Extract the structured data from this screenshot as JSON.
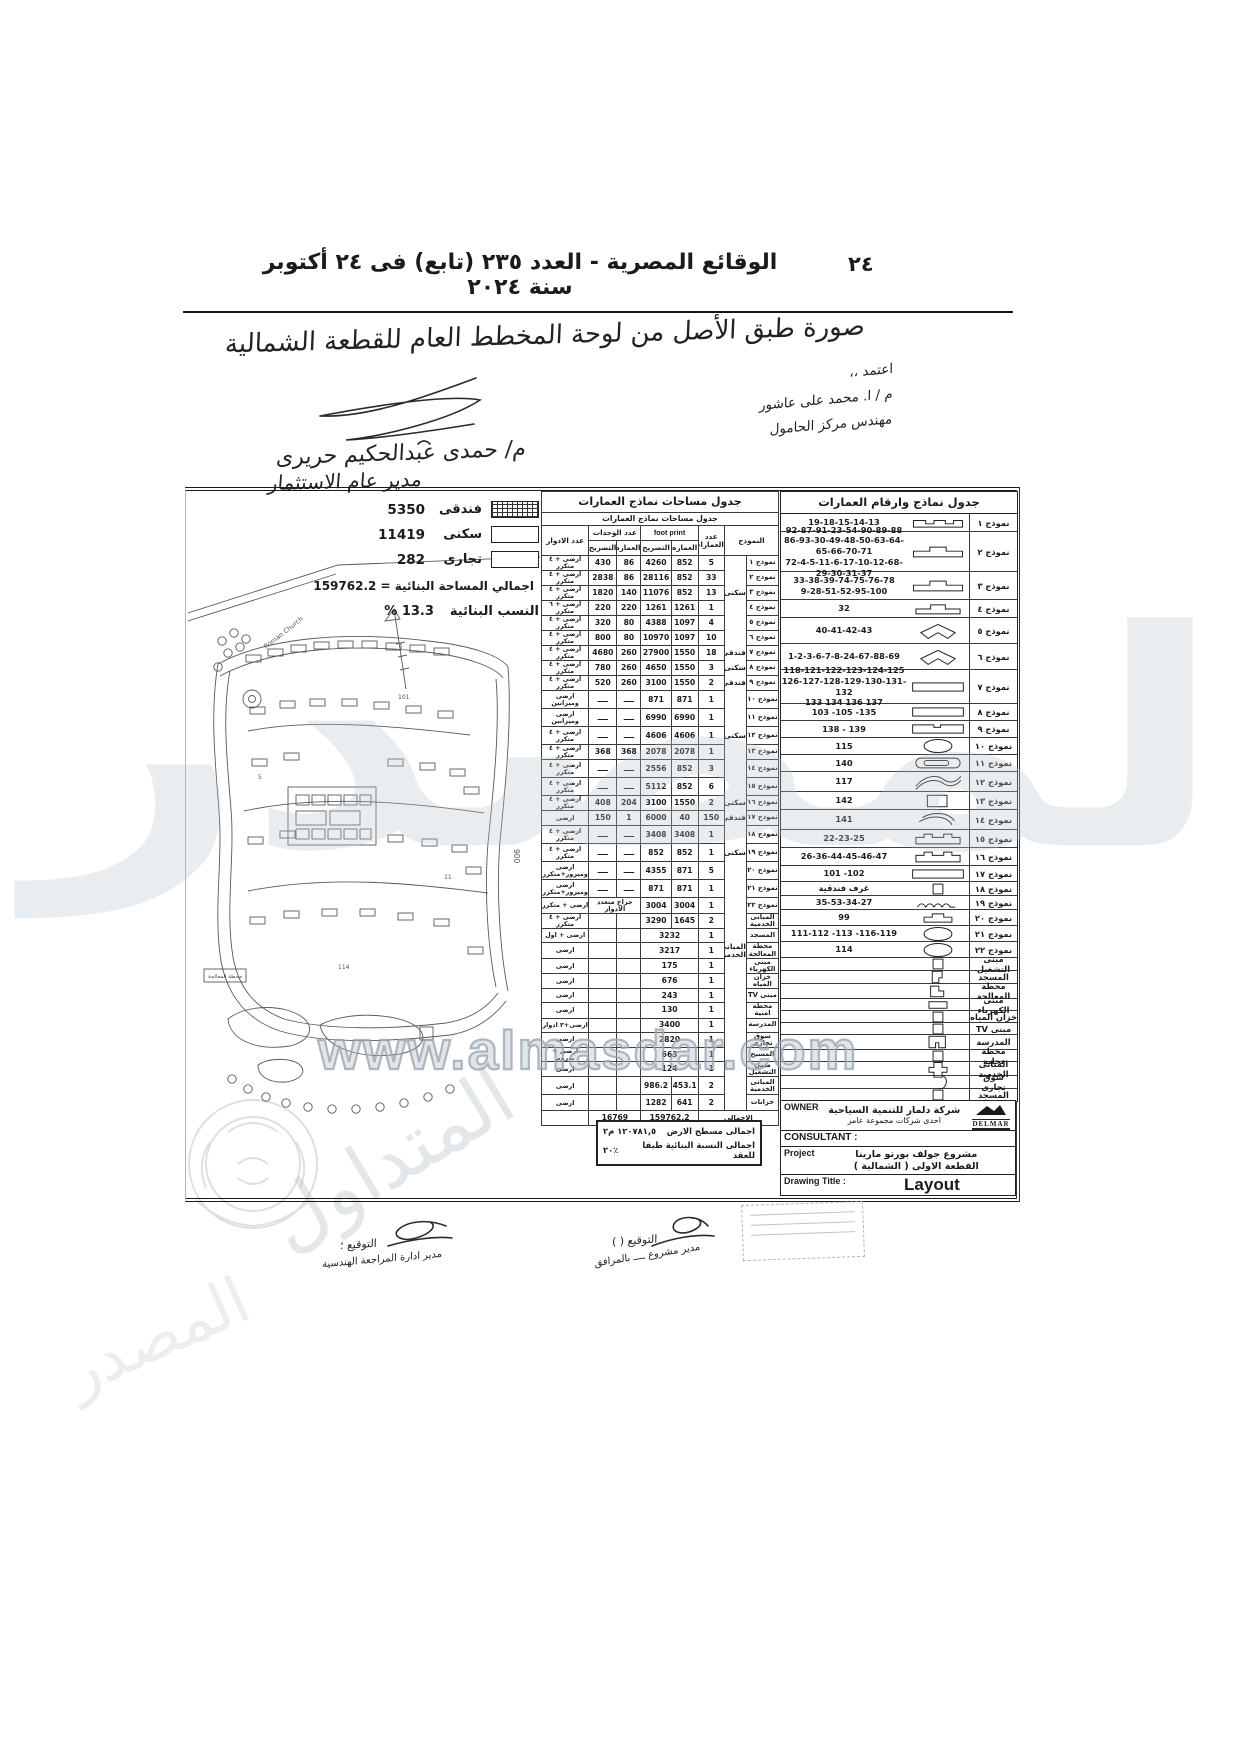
{
  "header": {
    "page_number": "٢٤",
    "gazette_title": "الوقائع المصرية - العدد ٢٣٥ (تابع) فى ٢٤ أكتوبر سنة ٢٠٢٤"
  },
  "handwritten": {
    "copy_note": "صورة طبق الأصل من لوحة المخطط العام للقطعة الشمالية",
    "approved_1": "اعتمد ،،",
    "approved_2": "م / ا. محمد على عاشور",
    "approved_3": "مهندس مركز الحامول",
    "name": "م/ حمدى عبدالحكيم حريرى",
    "job": "مدير عام الاستثمار",
    "sig_left_label": "التوقيع ؛",
    "sig_left_sub": "مدير ادارة المراجعة الهندسية",
    "sig_right_label": "التوقيع (      )",
    "sig_right_sub": "مدير مشروع ــــ بالمرافق"
  },
  "legend": {
    "items": [
      {
        "label": "فندقى",
        "value": "5350",
        "swatch": "hatched"
      },
      {
        "label": "سكنى",
        "value": "11419",
        "swatch": "plain"
      },
      {
        "label": "تجارى",
        "value": "282",
        "swatch": "plain"
      }
    ],
    "total_line": "اجمالي المساحة البنائية = 159762.2",
    "ratio_label": "النسب البنائية",
    "ratio_value": "% 13.3"
  },
  "map": {
    "church": "Roman Church",
    "road": "900",
    "station": "محطة المعالجة",
    "num1": "101",
    "num2": "5",
    "num3": "11",
    "num4": "114"
  },
  "area_table": {
    "title": "جدول مساحات نماذج العمارات",
    "subtitle": "جدول مساحات نماذج العمارات",
    "headers": {
      "model": "النموذج",
      "count": "عدد العمارات",
      "footprint": "foot print",
      "units": "عدد الوحدات",
      "floors": "عدد الادوار",
      "bldg": "العماره",
      "permit": "التصريح"
    },
    "rows": [
      {
        "m": "نموذج ١",
        "cat": "",
        "n": "5",
        "fb": "852",
        "ft": "4260",
        "ub": "86",
        "ut": "430",
        "fl": "ارضى + ٤ متكرر"
      },
      {
        "m": "نموذج ٢",
        "cat": "",
        "n": "33",
        "fb": "852",
        "ft": "28116",
        "ub": "86",
        "ut": "2838",
        "fl": "ارضى + ٤ متكرر"
      },
      {
        "m": "نموذج ٣",
        "cat": "سكنى",
        "n": "13",
        "fb": "852",
        "ft": "11076",
        "ub": "140",
        "ut": "1820",
        "fl": "ارضى + ٤ متكرر"
      },
      {
        "m": "نموذج ٤",
        "cat": "",
        "n": "1",
        "fb": "1261",
        "ft": "1261",
        "ub": "220",
        "ut": "220",
        "fl": "ارضى + ٦ متكرر"
      },
      {
        "m": "نموذج ٥",
        "cat": "",
        "n": "4",
        "fb": "1097",
        "ft": "4388",
        "ub": "80",
        "ut": "320",
        "fl": "ارضى + ٤ متكرر"
      },
      {
        "m": "نموذج ٦",
        "cat": "",
        "n": "10",
        "fb": "1097",
        "ft": "10970",
        "ub": "80",
        "ut": "800",
        "fl": "ارضى + ٤ متكرر"
      },
      {
        "m": "نموذج ٧",
        "cat": "فندقى",
        "n": "18",
        "fb": "1550",
        "ft": "27900",
        "ub": "260",
        "ut": "4680",
        "fl": "ارضى + ٤ متكرر"
      },
      {
        "m": "نموذج ٨",
        "cat": "سكنى",
        "n": "3",
        "fb": "1550",
        "ft": "4650",
        "ub": "260",
        "ut": "780",
        "fl": "ارضى + ٤ متكرر"
      },
      {
        "m": "نموذج ٩",
        "cat": "فندقى",
        "n": "2",
        "fb": "1550",
        "ft": "3100",
        "ub": "260",
        "ut": "520",
        "fl": "ارضى + ٤ متكرر"
      },
      {
        "m": "نموذج ١٠",
        "cat": "",
        "n": "1",
        "fb": "871",
        "ft": "871",
        "ub": "ــــ",
        "ut": "ــــ",
        "fl": "ارضى وميزانين",
        "big": true
      },
      {
        "m": "نموذج ١١",
        "cat": "",
        "n": "1",
        "fb": "6990",
        "ft": "6990",
        "ub": "ــــ",
        "ut": "ــــ",
        "fl": "ارضى وميزانين",
        "big": true
      },
      {
        "m": "نموذج ١٢",
        "cat": "سكنى",
        "n": "1",
        "fb": "4606",
        "ft": "4606",
        "ub": "ــــ",
        "ut": "ــــ",
        "fl": "ارضى + ٤ متكرر",
        "big": true
      },
      {
        "m": "نموذج ١٣",
        "cat": "",
        "n": "1",
        "fb": "2078",
        "ft": "2078",
        "ub": "368",
        "ut": "368",
        "fl": "ارضى + ٤ متكرر"
      },
      {
        "m": "نموذج ١٤",
        "cat": "",
        "n": "3",
        "fb": "852",
        "ft": "2556",
        "ub": "ــــ",
        "ut": "ــــ",
        "fl": "ارضى + ٤ متكرر",
        "big": true
      },
      {
        "m": "نموذج ١٥",
        "cat": "",
        "n": "6",
        "fb": "852",
        "ft": "5112",
        "ub": "ــــ",
        "ut": "ــــ",
        "fl": "ارضى + ٤ متكرر",
        "big": true
      },
      {
        "m": "نموذج ١٦",
        "cat": "سكنى",
        "n": "2",
        "fb": "1550",
        "ft": "3100",
        "ub": "204",
        "ut": "408",
        "fl": "ارضى + ٤ متكرر"
      },
      {
        "m": "نموذج ١٧",
        "cat": "فندقى",
        "n": "150",
        "fb": "40",
        "ft": "6000",
        "ub": "1",
        "ut": "150",
        "fl": "ارضى"
      },
      {
        "m": "نموذج ١٨",
        "cat": "",
        "n": "1",
        "fb": "3408",
        "ft": "3408",
        "ub": "ــــ",
        "ut": "ــــ",
        "fl": "ارضى + ٤ متكرر",
        "big": true
      },
      {
        "m": "نموذج ١٩",
        "cat": "سكنى",
        "n": "1",
        "fb": "852",
        "ft": "852",
        "ub": "ــــ",
        "ut": "ــــ",
        "fl": "ارضى + ٤ متكرر",
        "big": true
      },
      {
        "m": "نموذج ٢٠",
        "cat": "",
        "n": "5",
        "fb": "871",
        "ft": "4355",
        "ub": "ــــ",
        "ut": "ــــ",
        "fl": "ارضى وميزور+متكرر",
        "big": true
      },
      {
        "m": "نموذج ٢١",
        "cat": "",
        "n": "1",
        "fb": "871",
        "ft": "871",
        "ub": "ــــ",
        "ut": "ــــ",
        "fl": "ارضى وميزور+متكرر",
        "big": true
      },
      {
        "m": "نموذج ٢٢",
        "cat": "",
        "n": "1",
        "fb": "3004",
        "ft": "3004",
        "note": "جراج متعدد الادوار",
        "fl": "ارضى + متكرر",
        "mid": true
      },
      {
        "m": "المبانى الخدمية",
        "cat": "",
        "n": "2",
        "fb": "1645",
        "ft": "3290",
        "ub": "",
        "ut": "",
        "fl": "ارضى + ٤ متكرر"
      },
      {
        "m": "المسجد",
        "cat": "",
        "n": "1",
        "ft": "3232",
        "fspan": true,
        "fl": "ارضى + اول",
        "sm": true
      },
      {
        "m": "محطة المعالجة",
        "cat": "المبانى الخدمية",
        "n": "1",
        "ft": "3217",
        "fspan": true,
        "fl": "ارضى",
        "sm": true
      },
      {
        "m": "مبنى الكهرباء",
        "cat": "",
        "n": "1",
        "ft": "175",
        "fspan": true,
        "fl": "ارضى",
        "sm": true
      },
      {
        "m": "خزان المياه",
        "cat": "",
        "n": "1",
        "ft": "676",
        "fspan": true,
        "fl": "ارضى",
        "sm": true
      },
      {
        "m": "مبنى TV",
        "cat": "",
        "n": "1",
        "ft": "243",
        "fspan": true,
        "fl": "ارضى",
        "sm": true
      },
      {
        "m": "محطة امنية",
        "cat": "",
        "n": "1",
        "ft": "130",
        "fspan": true,
        "fl": "ارضى",
        "sm": true
      },
      {
        "m": "المدرسة",
        "cat": "",
        "n": "1",
        "ft": "3400",
        "fspan": true,
        "fl": "ارضى+٣ ادوار",
        "sm": true
      },
      {
        "m": "سوق تجارى",
        "cat": "",
        "n": "1",
        "ft": "2820",
        "fspan": true,
        "fl": "ارضى",
        "sm": true
      },
      {
        "m": "المسبح",
        "cat": "",
        "n": "1",
        "ft": "663",
        "fspan": true,
        "fl": "ارضى + بدروم",
        "sm": true
      },
      {
        "m": "مبنى التشغيل",
        "cat": "",
        "n": "1",
        "ft": "124",
        "fspan": true,
        "fl": "ارضى",
        "sm": true
      },
      {
        "m": "المبانى الخدمية",
        "cat": "",
        "n": "2",
        "fb": "453.1",
        "ft": "986.2",
        "ub": "",
        "ut": "",
        "fl": "ارضى",
        "big": true
      },
      {
        "m": "خزانات",
        "cat": "",
        "n": "2",
        "fb": "641",
        "ft": "1282",
        "ub": "",
        "ut": "",
        "fl": "ارضى",
        "mid": true
      }
    ],
    "totals": {
      "label": "الاجمالى",
      "units": "16769",
      "footprint": "159762.2"
    }
  },
  "model_table": {
    "title": "جدول نماذج وارقام العمارات",
    "rows": [
      {
        "m": "نموذج ١",
        "icon": "cren-a",
        "nums": [
          "19-18-15-14-13"
        ],
        "h": 18
      },
      {
        "m": "نموذج ٢",
        "icon": "cren-b",
        "nums": [
          "92-87-91-23-54-90-89-88",
          "86-93-30-49-48-50-63-64-65-66-70-71",
          "72-4-5-11-6-17-10-12-68-29-30-31-37"
        ],
        "h": 40
      },
      {
        "m": "نموذج ٣",
        "icon": "cren-b",
        "nums": [
          "33-38-39-74-75-76-78",
          "9-28-51-52-95-100"
        ],
        "h": 28
      },
      {
        "m": "نموذج ٤",
        "icon": "cren-c",
        "nums": [
          "32"
        ],
        "h": 18
      },
      {
        "m": "نموذج ٥",
        "icon": "wing",
        "nums": [
          "40-41-42-43"
        ],
        "h": 26
      },
      {
        "m": "نموذج ٦",
        "icon": "wing",
        "nums": [
          "1-2-3-6-7-8-24-67-88-69"
        ],
        "h": 26
      },
      {
        "m": "نموذج ٧",
        "icon": "longbar",
        "nums": [
          "118-121-122-123-124-125",
          "126-127-128-129-130-131-132",
          "133 134 136 137"
        ],
        "h": 34
      },
      {
        "m": "نموذج ٨",
        "icon": "longbar",
        "nums": [
          "103 -105 -135"
        ],
        "h": 17
      },
      {
        "m": "نموذج ٩",
        "icon": "longbar-notch",
        "nums": [
          "138 - 139"
        ],
        "h": 17
      },
      {
        "m": "نموذج ١٠",
        "icon": "ellipse",
        "nums": [
          "115"
        ],
        "h": 17
      },
      {
        "m": "نموذج ١١",
        "icon": "pill",
        "nums": [
          "140"
        ],
        "h": 17
      },
      {
        "m": "نموذج ١٢",
        "icon": "scurve",
        "nums": [
          "117"
        ],
        "h": 20
      },
      {
        "m": "نموذج ١٣",
        "icon": "rect",
        "nums": [
          "142"
        ],
        "h": 18
      },
      {
        "m": "نموذج ١٤",
        "icon": "arc",
        "nums": [
          "141"
        ],
        "h": 20
      },
      {
        "m": "نموذج ١٥",
        "icon": "cren-d",
        "nums": [
          "22-23-25"
        ],
        "h": 18
      },
      {
        "m": "نموذج ١٦",
        "icon": "cren-d",
        "nums": [
          "26-36-44-45-46-47"
        ],
        "h": 18
      },
      {
        "m": "نموذج ١٧",
        "icon": "longbar",
        "nums": [
          "101 -102"
        ],
        "h": 16
      },
      {
        "m": "نموذج ١٨",
        "icon": "smallrect",
        "nums": [
          "غرف فندقية"
        ],
        "h": 14
      },
      {
        "m": "نموذج ١٩",
        "icon": "humps",
        "nums": [
          "35-53-34-27"
        ],
        "h": 14
      },
      {
        "m": "نموذج ٢٠",
        "icon": "cren-sm",
        "nums": [
          "99"
        ],
        "h": 16
      },
      {
        "m": "نموذج ٢١",
        "icon": "ellipse",
        "nums": [
          "111-112 -113 -116-119"
        ],
        "h": 16
      },
      {
        "m": "نموذج ٢٢",
        "icon": "ellipse",
        "nums": [
          "114"
        ],
        "h": 16
      },
      {
        "m": "مبنى التشغيل",
        "icon": "smallrect",
        "nums": [],
        "h": 13
      },
      {
        "m": "المسجد",
        "icon": "lshape",
        "nums": [],
        "h": 13
      },
      {
        "m": "محطة المعالجة",
        "icon": "lshape2",
        "nums": [],
        "h": 15
      },
      {
        "m": "مبنى الكهرباء",
        "icon": "bar-sm",
        "nums": [],
        "h": 12
      },
      {
        "m": "خزان المياه",
        "icon": "smallrect",
        "nums": [],
        "h": 12
      },
      {
        "m": "مبنى TV",
        "icon": "smallrect",
        "nums": [],
        "h": 12
      },
      {
        "m": "المدرسة",
        "icon": "ushape",
        "nums": [],
        "h": 15
      },
      {
        "m": "محطة تحلية",
        "icon": "smallrect",
        "nums": [],
        "h": 12
      },
      {
        "m": "المبانى الخدمية",
        "icon": "cross",
        "nums": [],
        "h": 14
      },
      {
        "m": "سوق تجارى",
        "icon": "hook2",
        "nums": [],
        "h": 13
      },
      {
        "m": "المسجد",
        "icon": "smallrect",
        "nums": [],
        "h": 13
      },
      {
        "m": "خزان المياه",
        "icon": "tankbar",
        "nums": [],
        "h": 13
      }
    ]
  },
  "title_block": {
    "owner_label": "OWNER",
    "owner_ar": "شركة دلمار للتنمية السياحية",
    "owner_ar2": "احدى شركات مجموعة عامر",
    "logo_name": "DELMAR",
    "consultant_label": "CONSULTANT :",
    "project_label": "Project",
    "project_ar": "مشروع جولف بورتو مارينا",
    "project_ar2": "القطعة الاولى ( الشمالية )",
    "drawing_label": "Drawing Title :",
    "drawing_title": "Layout"
  },
  "notes": {
    "line1_label": "اجمالى مسطح الارض",
    "line1_value": "١٢٠٧٨١,٥ م٢",
    "line2_label": "اجمالى النسبة البنائية طبقا للعقد",
    "line2_value": "٢٠٪"
  },
  "watermark": {
    "site": "www.almasdar.com",
    "big": "المصدر",
    "diag1": "المتداول",
    "diag2": "المصدر"
  }
}
